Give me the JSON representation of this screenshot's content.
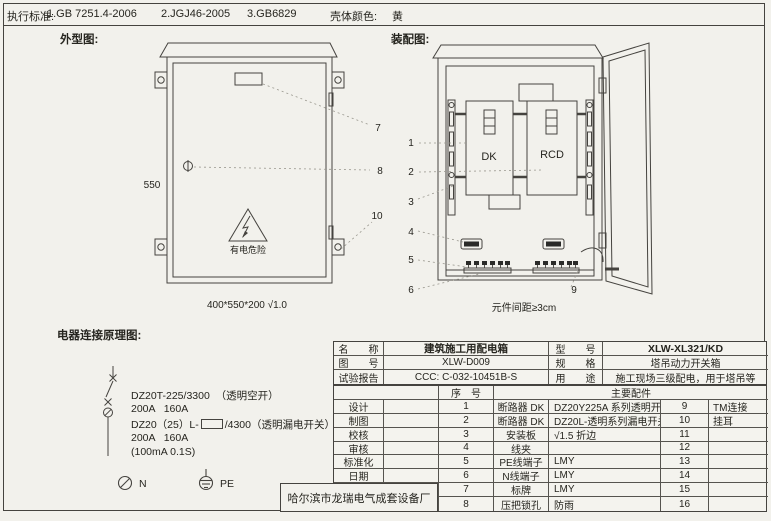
{
  "header": {
    "standards_label": "执行标准:",
    "standard1": "1.GB 7251.4-2006",
    "standard2": "2.JGJ46-2005",
    "standard3": "3.GB6829",
    "shell_color_label": "壳体颜色:",
    "shell_color": "黄"
  },
  "outline_drawing": {
    "title": "外型图:",
    "height_dim": "550",
    "size_note": "400*550*200 √1.0",
    "danger_text": "有电危险",
    "callout_7": "7",
    "callout_8": "8",
    "callout_10": "10"
  },
  "assembly_drawing": {
    "title": "装配图:",
    "dk": "DK",
    "rcd": "RCD",
    "spacing_note": "元件间距≥3cm",
    "callout_1": "1",
    "callout_2": "2",
    "callout_3": "3",
    "callout_4": "4",
    "callout_5": "5",
    "callout_6": "6",
    "callout_9": "9"
  },
  "schematic": {
    "title": "电器连接原理图:",
    "breaker1_model": "DZ20T-225/3300  （透明空开）",
    "breaker1_rating": "200A   160A",
    "breaker2_model_prefix": "DZ20（25）L-",
    "breaker2_model_suffix": "/4300（透明漏电开关）",
    "breaker2_rating": "200A   160A",
    "breaker2_leakage": "(100mA 0.1S)",
    "n_label": "N",
    "pe_label": "PE"
  },
  "info_table": {
    "name_label": "名　　称",
    "name_value": "建筑施工用配电箱",
    "model_label": "型　　号",
    "model_value": "XLW-XL321/KD",
    "drawing_no_label": "图　　号",
    "drawing_no_value": "XLW-D009",
    "spec_label": "规　　格",
    "spec_value": "塔吊动力开关箱",
    "test_report_label": "试验报告",
    "test_report_value": "CCC: C-032-10451B-S",
    "usage_label": "用　　途",
    "usage_value": "施工现场三级配电，用于塔吊等"
  },
  "parts_table": {
    "seq_header": "序　号",
    "parts_header": "主要配件",
    "rows": [
      {
        "role": "设计",
        "seq": "1",
        "item": "断路器 DK",
        "desc": "DZ20Y225A 系列透明开关",
        "seq2": "9",
        "item2": "TM连接"
      },
      {
        "role": "制图",
        "seq": "2",
        "item": "断路器 DK",
        "desc": "DZ20L-透明系列漏电开关",
        "seq2": "10",
        "item2": "挂耳"
      },
      {
        "role": "校核",
        "seq": "3",
        "item": "安装板",
        "desc": "√1.5 折边",
        "seq2": "11",
        "item2": ""
      },
      {
        "role": "审核",
        "seq": "4",
        "item": "线夹",
        "desc": "",
        "seq2": "12",
        "item2": ""
      },
      {
        "role": "标准化",
        "seq": "5",
        "item": "PE线端子",
        "desc": "LMY",
        "seq2": "13",
        "item2": ""
      },
      {
        "role": "日期",
        "seq": "6",
        "item": "N线端子",
        "desc": "LMY",
        "seq2": "14",
        "item2": ""
      },
      {
        "role": "",
        "seq": "7",
        "item": "标牌",
        "desc": "LMY",
        "seq2": "15",
        "item2": ""
      },
      {
        "role": "",
        "seq": "8",
        "item": "压把锁孔",
        "desc": "防雨",
        "seq2": "16",
        "item2": ""
      }
    ]
  },
  "manufacturer": "哈尔滨市龙瑞电气成套设备厂"
}
